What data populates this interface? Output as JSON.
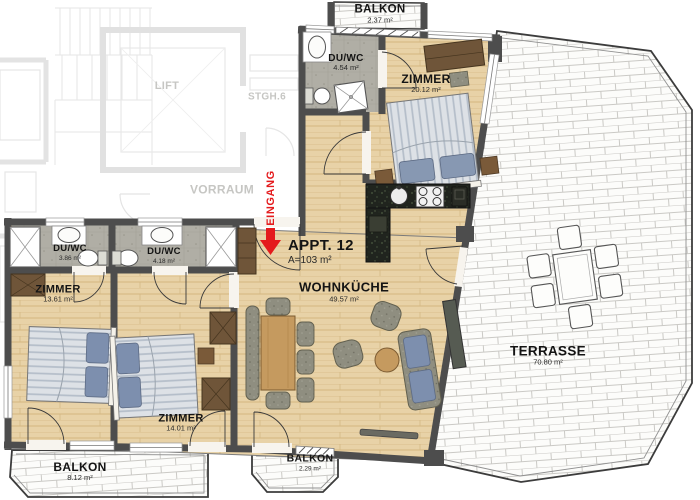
{
  "plan": {
    "apartment_label": "APPT. 12",
    "apartment_area": "A=103 m²",
    "entrance_label": "EINGANG",
    "rooms": [
      {
        "name": "BALKON",
        "area": "2.37 m²"
      },
      {
        "name": "DU/WC",
        "area": "4.54 m²"
      },
      {
        "name": "ZIMMER",
        "area": "20.12 m²"
      },
      {
        "name": "WOHNKÜCHE",
        "area": "49.57 m²"
      },
      {
        "name": "TERRASSE",
        "area": "70.80 m²"
      },
      {
        "name": "DU/WC",
        "area": "3.86 m²"
      },
      {
        "name": "DU/WC",
        "area": "4.18 m²"
      },
      {
        "name": "ZIMMER",
        "area": "13.61 m²"
      },
      {
        "name": "ZIMMER",
        "area": "14.01 m²"
      },
      {
        "name": "BALKON",
        "area": "8.12 m²"
      },
      {
        "name": "BALKON",
        "area": "2.29 m²"
      }
    ],
    "common_areas": {
      "lift": "LIFT",
      "stairwell": "STGH.6",
      "hall": "VORRAUM"
    },
    "colors": {
      "accent_red": "#e41a1c",
      "wall_gray": "#4d4d4d",
      "floor_wood": "#e8d2a7",
      "floor_bath": "#b0aea5",
      "terrace_brick": "#fcfcfa"
    }
  }
}
